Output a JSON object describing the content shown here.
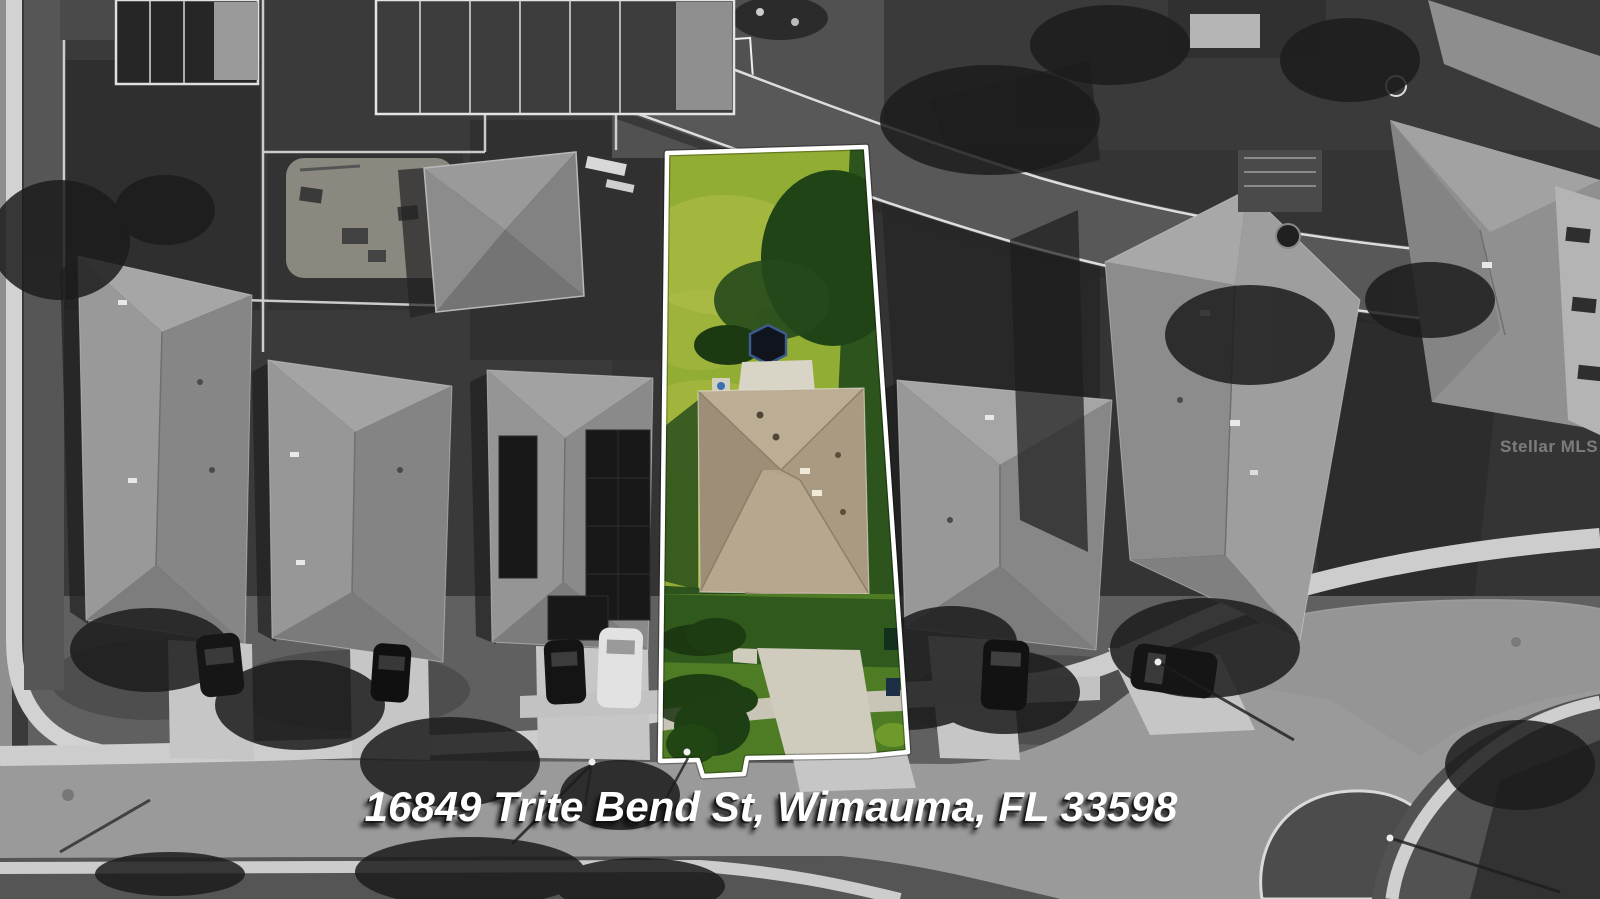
{
  "address_overlay": {
    "text": "16849 Trite Bend St, Wimauma, FL 33598"
  },
  "watermark": {
    "text": "Stellar MLS"
  },
  "colors": {
    "grass_bright": "#92ad33",
    "grass_mid": "#6f9a2b",
    "grass_dark": "#2c541c",
    "grass_front": "#4e7c25",
    "roof_tan": "#b2a389",
    "roof_tan_dark": "#9d8f77",
    "roof_tan_light": "#bcae95",
    "driveway_tan": "#d0ccbd",
    "outline_white": "#ffffff",
    "address_text": "#ffffff",
    "watermark_gray": "#e0e0e0"
  }
}
